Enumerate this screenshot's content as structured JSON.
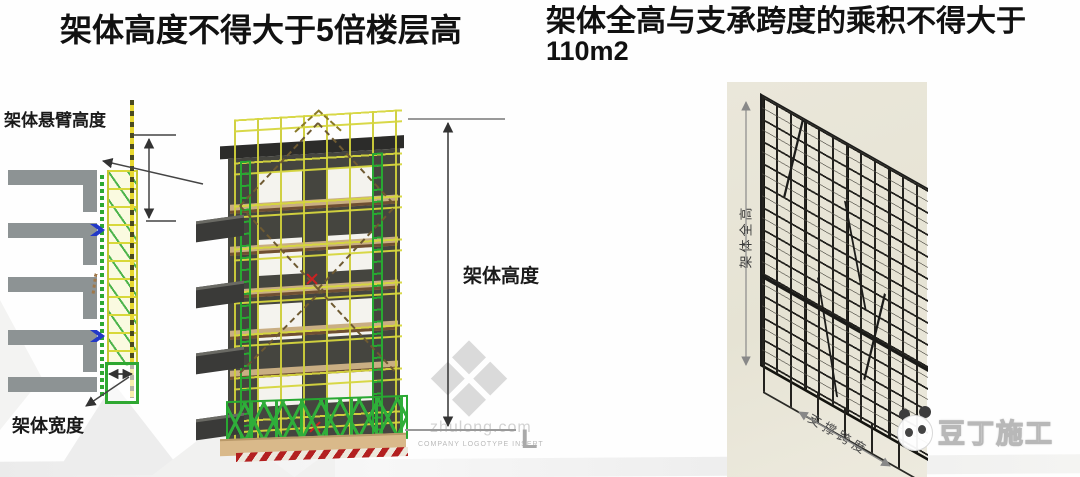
{
  "titles": {
    "left": {
      "pre": "架体高度不得大于",
      "emphasis": "5",
      "post": "倍楼层高"
    },
    "right": {
      "line1": "架体全高与支承跨度的乘积不得大于",
      "line2": "110m2"
    }
  },
  "left_diagram": {
    "cantilever_height_label": "架体悬臂高度",
    "width_label": "架体宽度"
  },
  "middle_diagram": {
    "height_label": "架体高度",
    "watermark": {
      "brand": "zhulong.com",
      "caption": "COMPANY LOGOTYPE INSERT",
      "initial": "L"
    }
  },
  "right_diagram": {
    "total_height_label": "架体全高",
    "span_label": "支撑跨度"
  },
  "brand_logo": {
    "text": "豆丁施工"
  },
  "colors": {
    "scaffold_yellow": "#d8d83a",
    "scaffold_green": "#2fa832",
    "panel_beige": "#e9e6d9",
    "hazard_red": "#b32020",
    "slab_gray": "#8d9394",
    "building_dark": "#45453f",
    "anchor_blue": "#2238c8"
  }
}
